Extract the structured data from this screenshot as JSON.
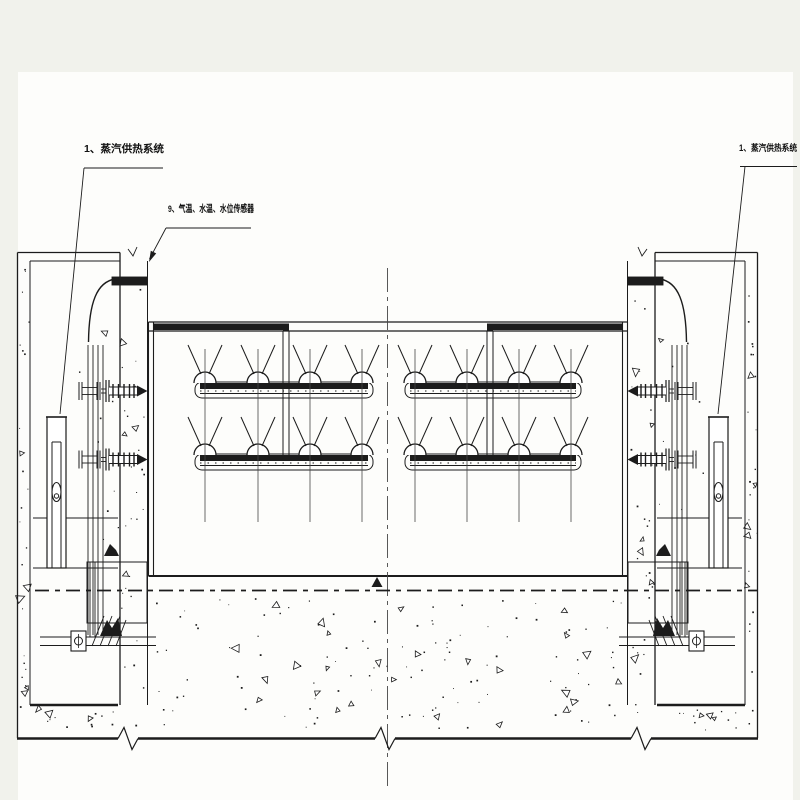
{
  "colors": {
    "page_bg": "#f1f2ec",
    "sheet_bg": "#fdfdfb",
    "ink": "#1c1c1c",
    "soft_line": "#474747"
  },
  "labels": {
    "steam_left": "1、蒸汽供热系统",
    "steam_right": "1、蒸汽供热系统",
    "sensors": "9、气温、水温、水位传感器"
  },
  "diagram": {
    "type": "engineering-section",
    "mirror_width": 775,
    "sheet": [
      18,
      72,
      775,
      728
    ],
    "pier": {
      "outer_x": 17.5,
      "inner_x": 30,
      "cap_y1": 252.5,
      "cap_y2": 261,
      "face_x": 120,
      "face2_x": 147.5,
      "chamber_bottom_y": 705,
      "waterline_ys": [
        518,
        568
      ],
      "chamber": [
        33,
        118
      ]
    },
    "tank": {
      "x1": 148.5,
      "x2": 627.5,
      "wall_gap": 5,
      "top_y1": 322,
      "top_y2": 331,
      "bottom_y": 576,
      "dark_segments": [
        [
          153,
          283
        ],
        [
          490,
          623
        ]
      ],
      "feed_pipes_x": [
        283,
        487
      ],
      "feed_width": 6
    },
    "nozzle_rows": {
      "bar_ys": [
        383,
        455
      ],
      "assemblies": [
        {
          "x1": 195,
          "x2": 373,
          "nozzles": [
            205,
            258,
            310,
            362
          ]
        },
        {
          "x1": 405,
          "x2": 581,
          "nozzles": [
            415,
            467,
            519,
            571
          ]
        }
      ],
      "dome_radius": 11,
      "vline_y1": 349,
      "vline_y2": 522
    },
    "fittings": {
      "center_ys": [
        391,
        459.5
      ]
    },
    "cylinder": {
      "x1": 47,
      "x2": 66,
      "top": 417,
      "bottom": 568,
      "inner": [
        52,
        61
      ],
      "inner_top": 442
    },
    "steam_pipe": {
      "bar": [
        112,
        277,
        147,
        285
      ],
      "verticals_x": [
        88,
        93,
        98,
        103
      ],
      "v_y1": 345,
      "v_y2": 635
    },
    "anchor_base": {
      "lines_y": [
        637,
        645.5
      ],
      "lines_x": [
        40,
        156
      ],
      "bolt_box": [
        71,
        631,
        15,
        20
      ],
      "lower_box": [
        87,
        562,
        60,
        61
      ]
    },
    "centerline": {
      "x": 387.5,
      "y1": 268,
      "y2": 790
    },
    "foundation_axis": {
      "y": 590.5,
      "x1": 35,
      "x2": 757
    },
    "bottom_edge": {
      "y": 738.5,
      "x1": 17,
      "x2": 758,
      "breaks_x": [
        128,
        385,
        641
      ]
    },
    "leaders": {
      "left": {
        "underline": [
          84,
          168,
          163
        ],
        "line": [
          [
            84,
            168
          ],
          [
            60,
            414
          ]
        ]
      },
      "right": {
        "underline": [
          740,
          166.5,
          797
        ],
        "line": [
          [
            745,
            166.5
          ],
          [
            718,
            414
          ]
        ]
      },
      "center": {
        "underline": [
          166,
          228,
          251
        ],
        "line": [
          [
            166,
            228
          ],
          [
            149.5,
            259
          ]
        ],
        "arrow": [
          [
            149,
            262
          ],
          [
            156.2,
            253.4
          ],
          [
            150.8,
            250.7
          ]
        ]
      }
    },
    "speckle_regions": [
      [
        19,
        256,
        29,
        733,
        22,
        5
      ],
      [
        121,
        264,
        146,
        730,
        26,
        6
      ],
      [
        630,
        264,
        655,
        730,
        26,
        6
      ],
      [
        747,
        256,
        757,
        733,
        22,
        5
      ],
      [
        156,
        598,
        624,
        729,
        110,
        26
      ],
      [
        33,
        708,
        116,
        730,
        10,
        3
      ],
      [
        660,
        708,
        742,
        730,
        10,
        3
      ],
      [
        70,
        330,
        118,
        555,
        9,
        1
      ],
      [
        658,
        330,
        706,
        555,
        9,
        1
      ]
    ]
  }
}
